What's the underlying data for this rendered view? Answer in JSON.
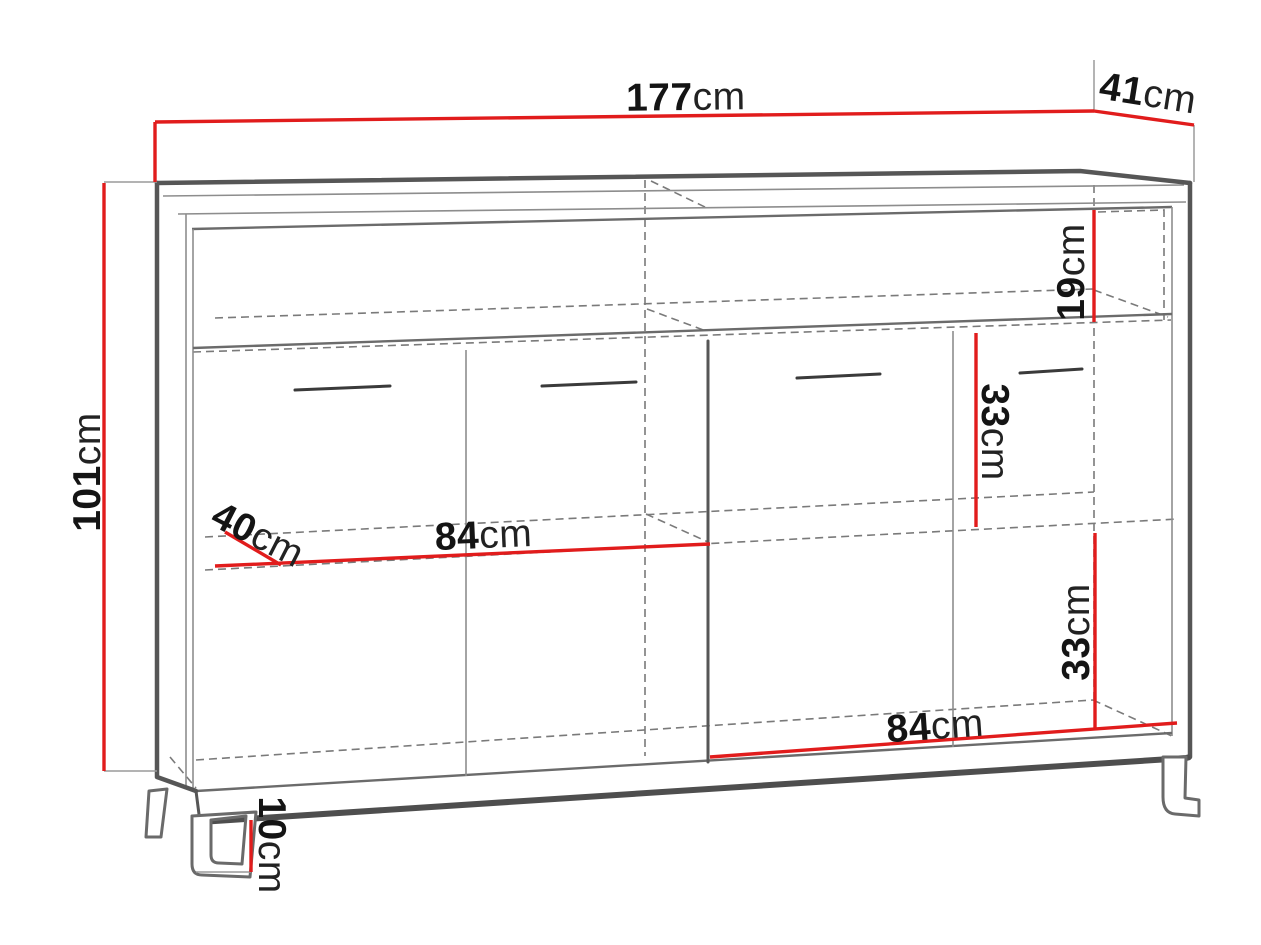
{
  "diagram": {
    "type": "furniture-dimension-drawing",
    "subject": "sideboard cabinet with four doors, open top shelf and metal legs",
    "unit": "cm",
    "colors": {
      "dimension_line": "#e11c1c",
      "outline": "#565656",
      "hidden_edge": "#7a7a7a",
      "background": "#ffffff"
    },
    "dimensions": {
      "width": {
        "value": "177",
        "unit": "cm",
        "meaning": "overall width"
      },
      "depth": {
        "value": "41",
        "unit": "cm",
        "meaning": "overall depth"
      },
      "height": {
        "value": "101",
        "unit": "cm",
        "meaning": "overall height"
      },
      "top_shelf": {
        "value": "19",
        "unit": "cm",
        "meaning": "open top shelf inner height"
      },
      "upper_inner": {
        "value": "33",
        "unit": "cm",
        "meaning": "upper compartment inner height"
      },
      "lower_inner": {
        "value": "33",
        "unit": "cm",
        "meaning": "lower compartment inner height"
      },
      "left_inner_width": {
        "value": "84",
        "unit": "cm",
        "meaning": "left compartment inner width"
      },
      "right_inner_width": {
        "value": "84",
        "unit": "cm",
        "meaning": "right compartment inner width"
      },
      "inner_depth": {
        "value": "40",
        "unit": "cm",
        "meaning": "inner shelf depth"
      },
      "leg_height": {
        "value": "10",
        "unit": "cm",
        "meaning": "leg height"
      }
    }
  }
}
